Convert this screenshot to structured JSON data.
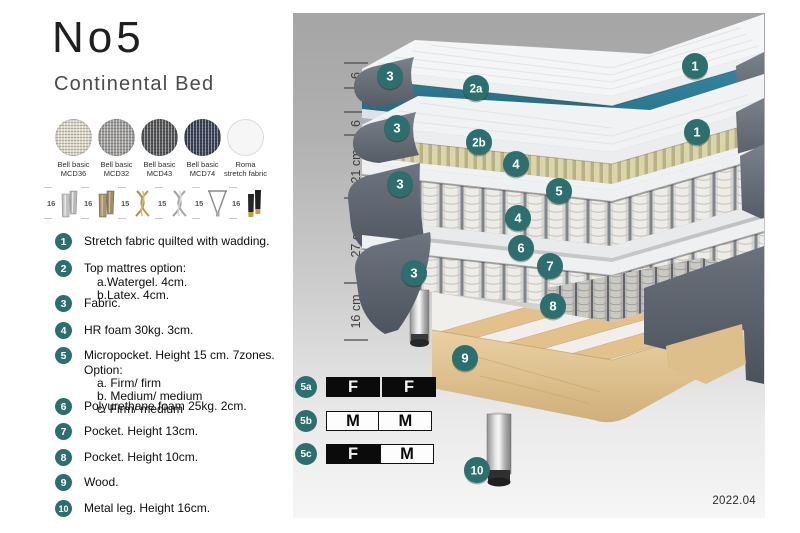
{
  "header": {
    "title": "No5",
    "subtitle": "Continental Bed"
  },
  "fabrics": [
    {
      "line1": "Bell basic",
      "line2": "MCD36",
      "color": "#ddd7c8"
    },
    {
      "line1": "Bell basic",
      "line2": "MCD32",
      "color": "#a09f9d"
    },
    {
      "line1": "Bell basic",
      "line2": "MCD43",
      "color": "#56585a"
    },
    {
      "line1": "Bell basic",
      "line2": "MCD74",
      "color": "#3d4358"
    },
    {
      "line1": "Roma",
      "line2": "stretch fabric",
      "color": "#f6f6f6"
    }
  ],
  "legs": [
    {
      "height": "16",
      "style": "cylinder-silver"
    },
    {
      "height": "16",
      "style": "cylinder-bronze"
    },
    {
      "height": "15",
      "style": "twisted-gold"
    },
    {
      "height": "15",
      "style": "twisted-silver"
    },
    {
      "height": "15",
      "style": "hairpin"
    },
    {
      "height": "16",
      "style": "cylinder-black-gold"
    }
  ],
  "spec_list": [
    {
      "num": "1",
      "text": "Stretch fabric quilted with wadding."
    },
    {
      "num": "2",
      "text": "Top mattres option:",
      "sub": [
        "a.Watergel. 4cm.",
        "b.Latex. 4cm."
      ]
    },
    {
      "num": "3",
      "text": "Fabric."
    },
    {
      "num": "4",
      "text": "HR foam 30kg. 3cm."
    },
    {
      "num": "5",
      "text": "Micropocket. Height 15 cm. 7zones. Option:",
      "sub": [
        "a. Firm/ firm",
        "b. Medium/ medium",
        "c. Firm/ medium"
      ]
    },
    {
      "num": "6",
      "text": "Polyurethane foam 25kg. 2cm."
    },
    {
      "num": "7",
      "text": "Pocket. Height 13cm."
    },
    {
      "num": "8",
      "text": "Pocket. Height 10cm."
    },
    {
      "num": "9",
      "text": "Wood."
    },
    {
      "num": "10",
      "text": "Metal leg. Height 16cm."
    }
  ],
  "diagram": {
    "ruler": [
      "6",
      "6",
      "21 cm",
      "27 cm",
      "16 cm"
    ],
    "callouts": [
      "1",
      "3",
      "2a",
      "3",
      "2b",
      "1",
      "4",
      "5",
      "3",
      "4",
      "6",
      "7",
      "3",
      "8",
      "9",
      "10"
    ],
    "version": "2022.04"
  },
  "firmness": {
    "rows": [
      {
        "label": "5a",
        "cells": [
          {
            "text": "F",
            "filled": true
          },
          {
            "text": "F",
            "filled": true
          }
        ]
      },
      {
        "label": "5b",
        "cells": [
          {
            "text": "M",
            "filled": false
          },
          {
            "text": "M",
            "filled": false
          }
        ]
      },
      {
        "label": "5c",
        "cells": [
          {
            "text": "F",
            "filled": true
          },
          {
            "text": "M",
            "filled": false
          }
        ]
      }
    ]
  },
  "colors": {
    "accent_teal": "#2d6f6e",
    "watergel_teal": "#2d7d96",
    "latex_khaki": "#d9d3aa",
    "wood_tan": "#e5cb9c",
    "fabric_gray": "#6a717b"
  }
}
